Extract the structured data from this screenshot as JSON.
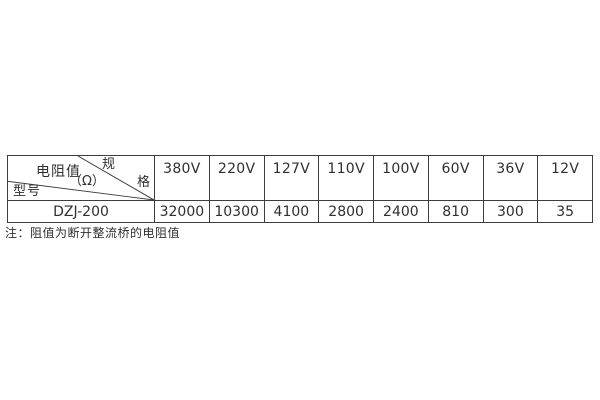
{
  "table": {
    "corner": {
      "spec_top": "规",
      "spec_bottom": "格",
      "resistance_label": "电阻值",
      "resistance_unit": "（Ω）",
      "model_label": "型号"
    },
    "columns": [
      "380V",
      "220V",
      "127V",
      "110V",
      "100V",
      "60V",
      "36V",
      "12V"
    ],
    "rows": [
      {
        "model": "DZJ-200",
        "values": [
          "32000",
          "10300",
          "4100",
          "2800",
          "2400",
          "810",
          "300",
          "35"
        ]
      }
    ]
  },
  "note": "注：阻值为断开整流桥的电阻值"
}
